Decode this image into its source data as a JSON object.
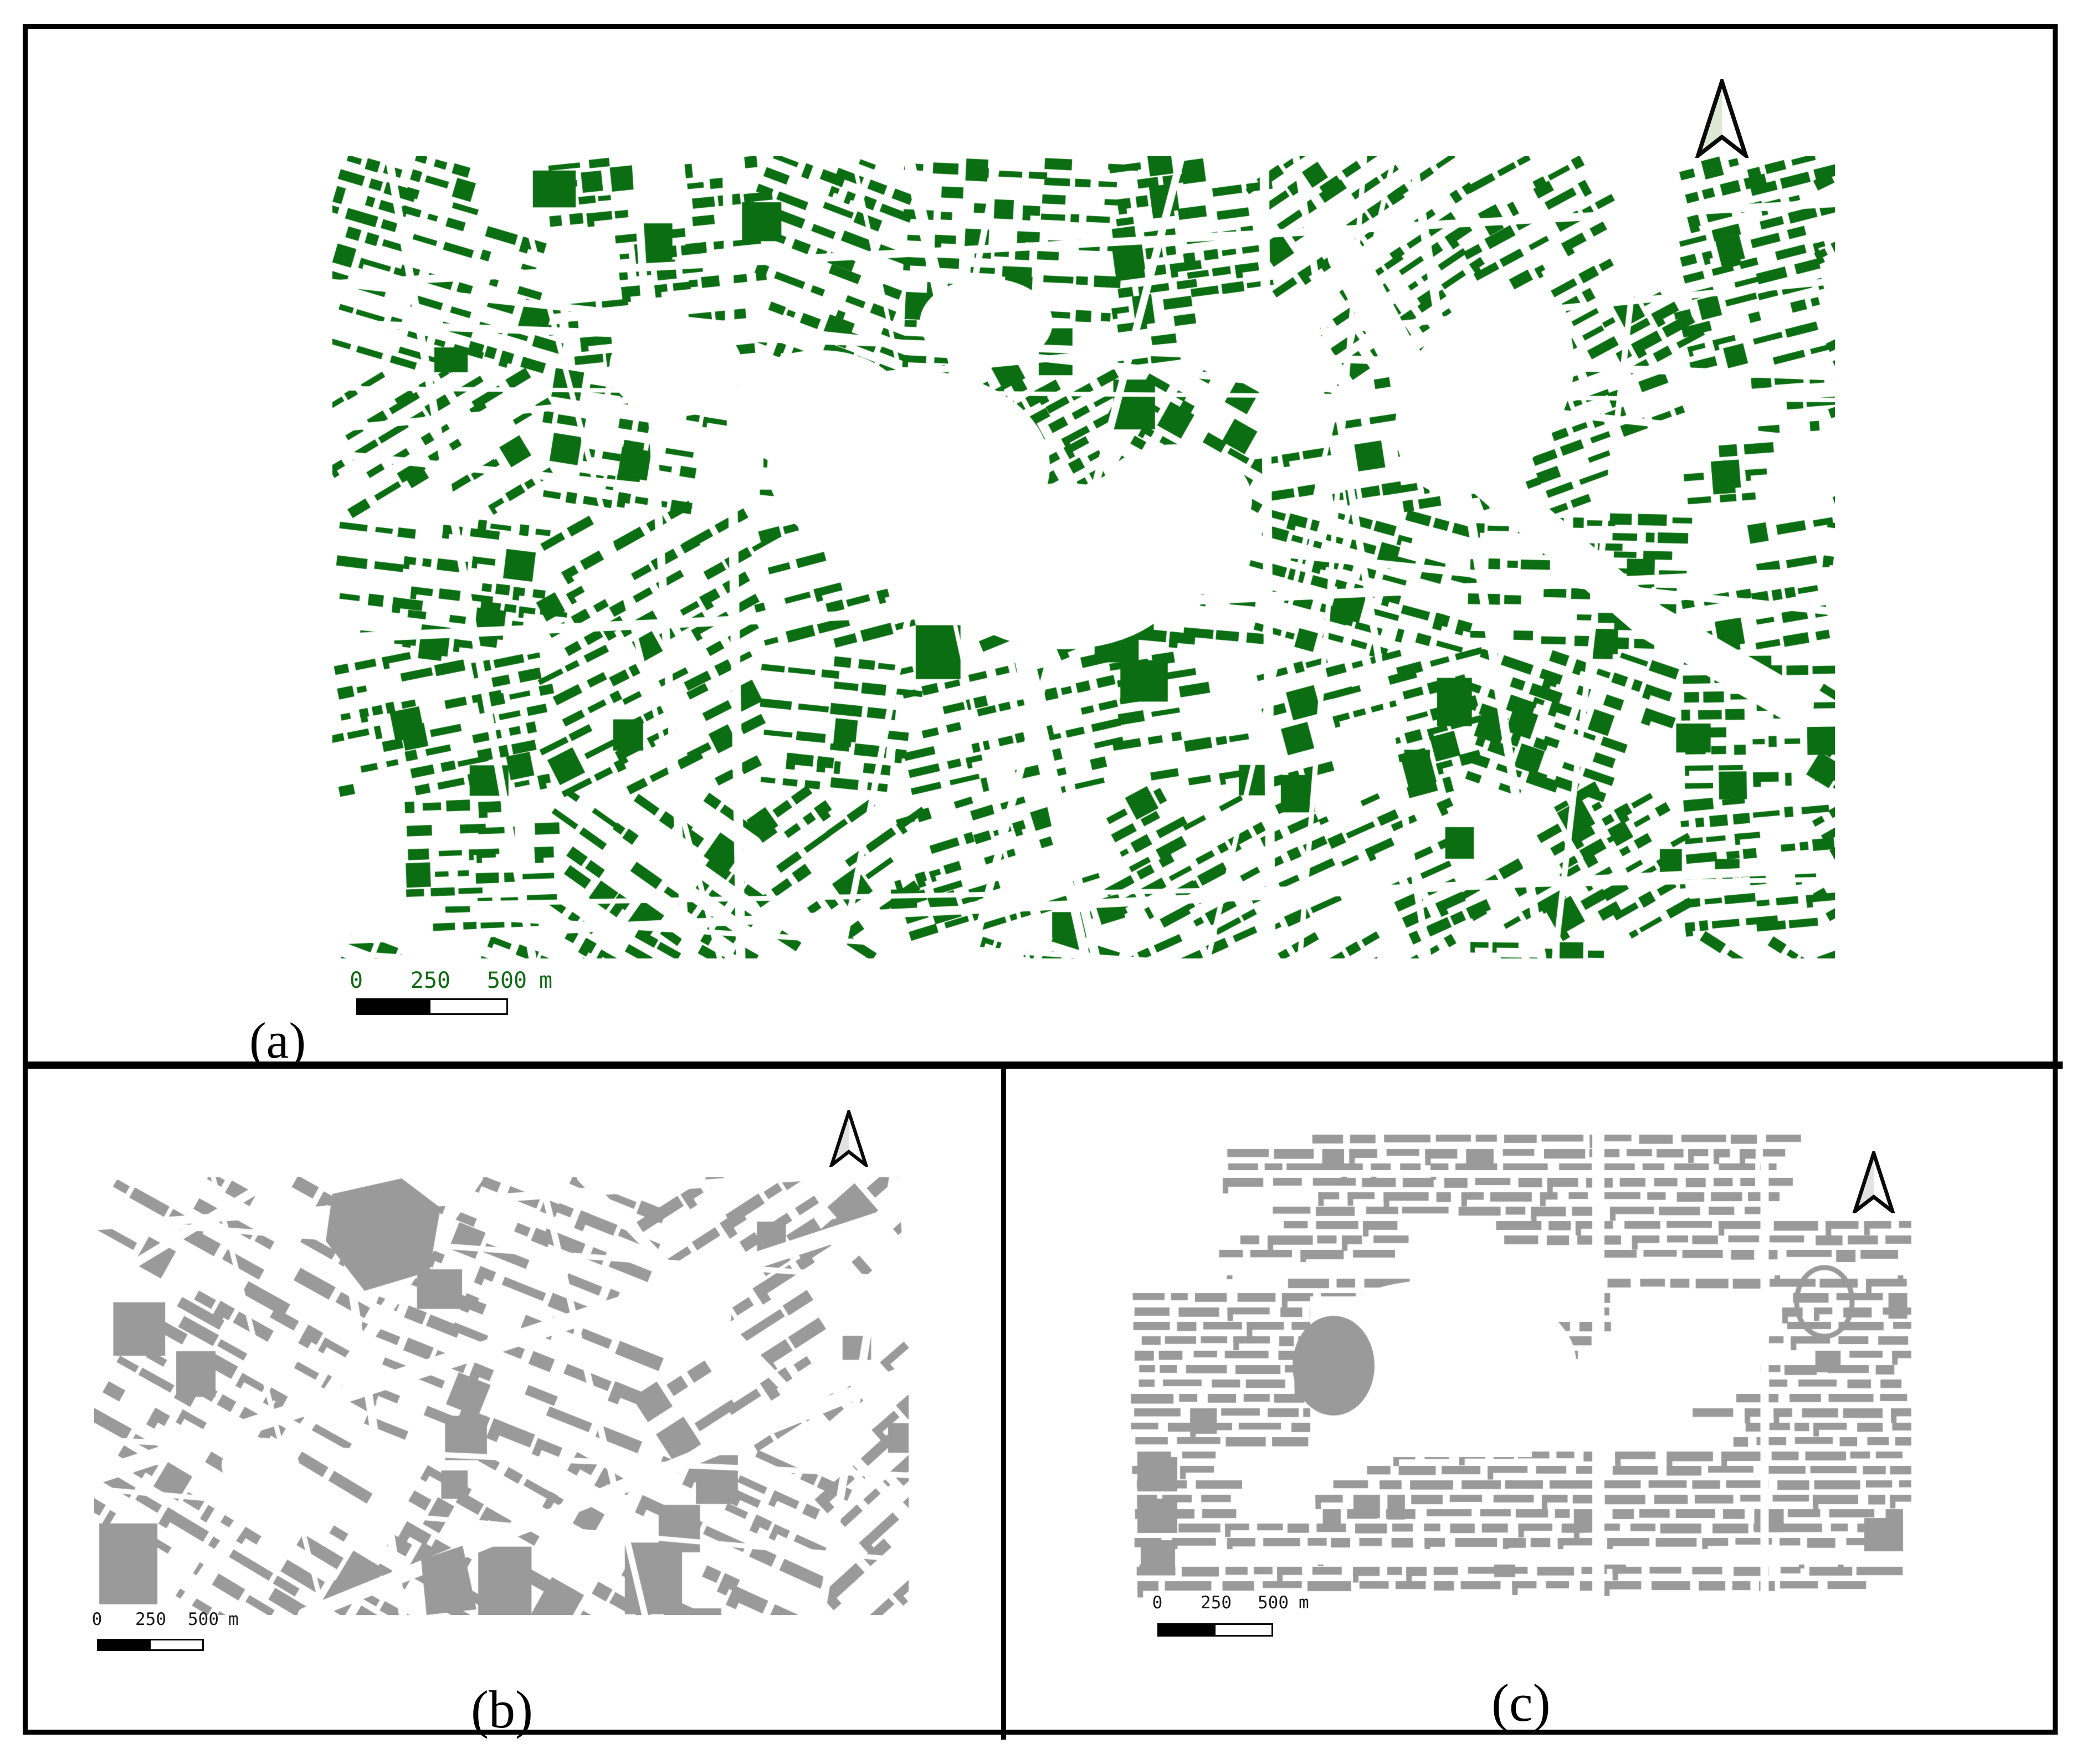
{
  "figure": {
    "background": "#ffffff",
    "frame_color": "#000000"
  },
  "panels": {
    "a": {
      "label": "(a)",
      "building_color": "#0b6e12",
      "arrow_fill": "#dce8d4",
      "scalebar": {
        "zero": "0",
        "mid": "250",
        "max": "500",
        "unit": "m",
        "text_color": "#0f6a14"
      }
    },
    "b": {
      "label": "(b)",
      "building_color": "#9a9a9a",
      "arrow_fill": "#e2e2e2",
      "scalebar": {
        "zero": "0",
        "mid": "250",
        "max": "500",
        "unit": "m",
        "text_color": "#1a1a1a"
      }
    },
    "c": {
      "label": "(c)",
      "building_color": "#9a9a9a",
      "arrow_fill": "#e2e2e2",
      "scalebar": {
        "zero": "0",
        "mid": "250",
        "max": "500",
        "unit": "m",
        "text_color": "#1a1a1a"
      }
    }
  }
}
